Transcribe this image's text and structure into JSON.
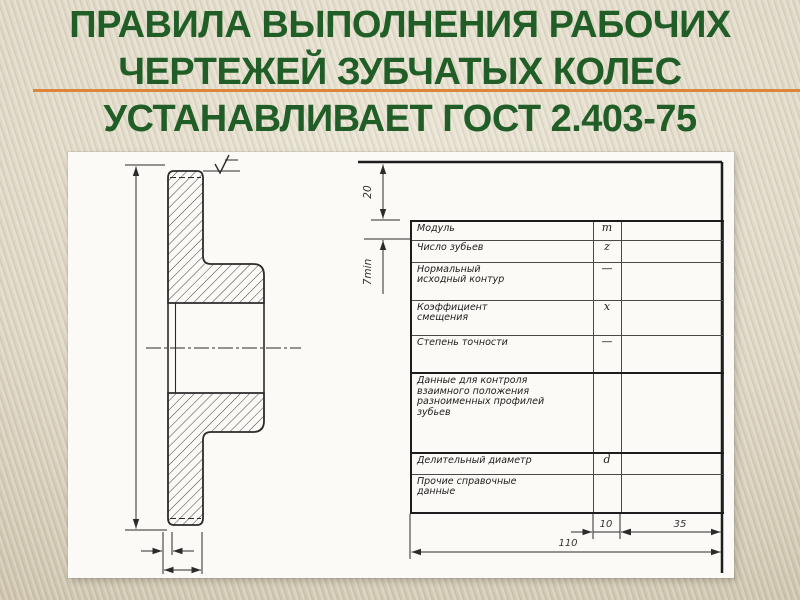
{
  "title": {
    "lines": [
      "ПРАВИЛА ВЫПОЛНЕНИЯ РАБОЧИХ",
      "ЧЕРТЕЖЕЙ ЗУБЧАТЫХ КОЛЕС",
      "УСТАНАВЛИВАЕТ ГОСТ 2.403-75"
    ],
    "title_color": "#215e27",
    "accent_color": "#dd863b"
  },
  "figure": {
    "dims": {
      "top_gap": "20",
      "row_min": "7min",
      "col_symbol": "10",
      "col_value": "35",
      "table_width": "110"
    },
    "table": {
      "rows": [
        {
          "name": "Модуль",
          "symbol": "m",
          "value": ""
        },
        {
          "name": "Число зубьев",
          "symbol": "z",
          "value": ""
        },
        {
          "name": "Нормальный\nисходный контур",
          "symbol": "—",
          "value": ""
        },
        {
          "name": "Коэффициент\nсмещения",
          "symbol": "x",
          "value": ""
        },
        {
          "name": "Степень точности",
          "symbol": "—",
          "value": ""
        },
        {
          "name": "Данные для контроля\nвзаимного положения\nразноименных профилей\nзубьев",
          "symbol": "",
          "value": ""
        },
        {
          "name": "Делительный диаметр",
          "symbol": "d",
          "value": ""
        },
        {
          "name": "Прочие справочные\nданные",
          "symbol": "",
          "value": ""
        }
      ]
    }
  }
}
